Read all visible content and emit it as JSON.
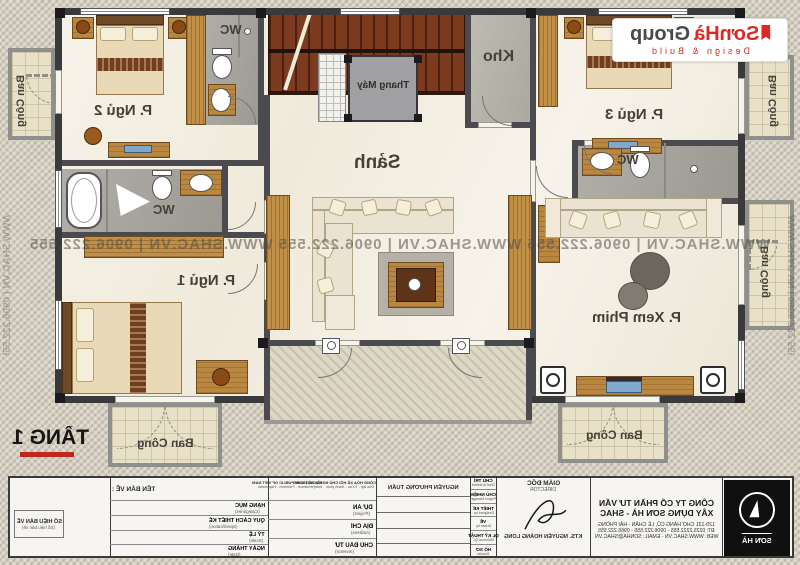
{
  "floor": {
    "label": "TẦNG 1"
  },
  "logo": {
    "brand": "SơnHà",
    "brand2": "Group",
    "tagline": "Design & Build"
  },
  "watermark": {
    "unit": "WWW.SHAC.VN | 0906.222.555",
    "row": "WWW.SHAC.VN  |  0906.222.555        WWW.SHAC.VN  |  0906.222.555        WWW.SHAC.VN  |  0906.222.555"
  },
  "rooms": {
    "hall": "Sảnh",
    "elevator": "Thang Máy",
    "storage": "Kho",
    "bedroom1": "P. Ngủ 1",
    "bedroom2": "P. Ngủ 2",
    "bedroom3": "P. Ngủ 3",
    "cinema": "P. Xem Phim",
    "wc": "WC",
    "balcony": "Ban Công"
  },
  "colors": {
    "accent_red": "#c0281e",
    "logo_red": "#e02823",
    "wall": "#3a393b"
  },
  "titleblock": {
    "drawing_no_label": "SỐ HIỆU BẢN VẼ",
    "drawing_no_sub": "(Số hiệu bản vẽ)",
    "drawing_name_label": "TÊN BẢN VẼ :",
    "motto_en_1": "SOCIALIST REPUBLIC OF VIET NAM",
    "motto_en_2": "Independence - Freedom - Happiness",
    "motto_vn_1": "CỘNG HÒA XÃ HỘI CHỦ NGHĨA VIỆT NAM",
    "motto_vn_2": "Độc lập - Tự do - Hạnh phúc",
    "spec_rows": [
      {
        "vn": "HẠNG MỤC",
        "en": "(Categories)"
      },
      {
        "vn": "QUY CÁCH THIẾT KẾ",
        "en": "(Specification)"
      },
      {
        "vn": "TỶ LỆ",
        "en": "(Scale)"
      },
      {
        "vn": "NGÀY THÁNG",
        "en": "(Date)"
      }
    ],
    "project_rows": [
      {
        "vn": "DỰ ÁN",
        "en": "(Project)"
      },
      {
        "vn": "ĐỊA CHỈ",
        "en": "(Address)"
      },
      {
        "vn": "CHỦ ĐẦU TƯ",
        "en": "(Investor)"
      }
    ],
    "staff_rows": [
      {
        "vn": "CHỦ TRÌ",
        "en": "Chief Architect"
      },
      {
        "vn": "CHỦ NHIỆM",
        "en": "Project Manager"
      },
      {
        "vn": "THIẾT KẾ",
        "en": "Designed by"
      },
      {
        "vn": "VẼ",
        "en": "Drawn by"
      },
      {
        "vn": "QL KỸ THUẬT",
        "en": "Technical QC"
      },
      {
        "vn": "HỒ SƠ",
        "en": "Dossier"
      }
    ],
    "architect_name": "NGUYỄN PHƯƠNG TUẤN",
    "director_label": "GIÁM ĐỐC",
    "director_label_en": "DIRECTOR",
    "director_name": "KTS. NGUYỄN HOÀNG LONG",
    "company_line1": "CÔNG TY CỔ PHẦN TƯ VẤN",
    "company_line2": "XÂY DỰNG SƠN HÀ - SHAC",
    "address_line": "129-131 CHỢ HÀNG CŨ, LÊ CHÂN - HẢI PHÒNG",
    "phone_line": "ĐT: 0225.2222.555 - 0906.222.555 - 0966.222.555",
    "web_line": "WEB: WWW.SHAC.VN - EMAIL: SONHA@SHAC.VN",
    "brand_name": "SƠN HÀ"
  }
}
